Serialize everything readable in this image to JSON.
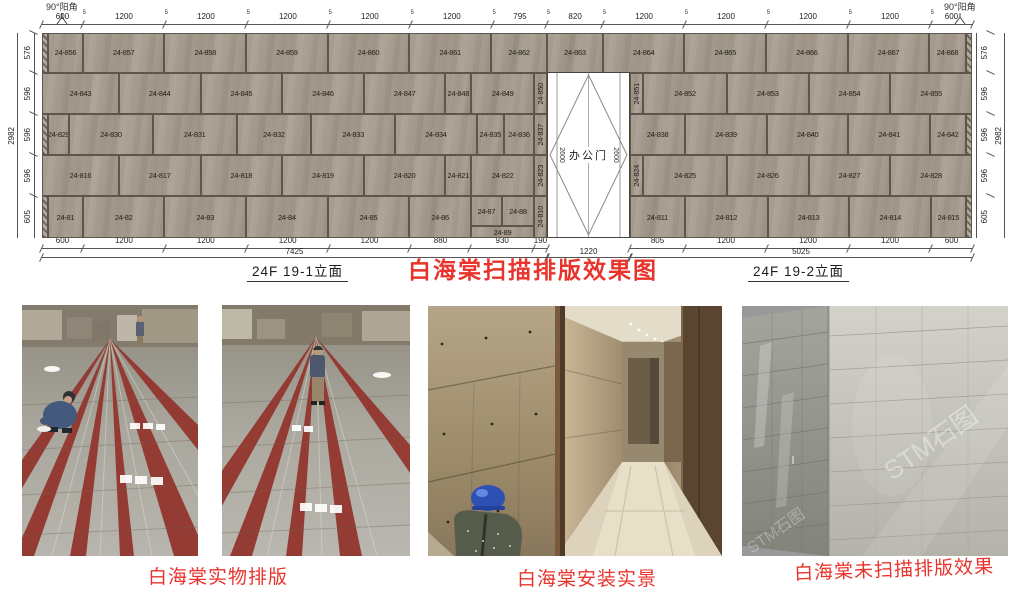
{
  "drawing": {
    "title": "白海棠扫描排版效果图",
    "corner_left": "90°阳角",
    "corner_right": "90°阳角",
    "elev_left_label": "24F 19-1立面",
    "elev_right_label": "24F 19-2立面",
    "door": {
      "label": "办公门",
      "height_dim": "2600",
      "width_dim": "1220"
    },
    "totals": {
      "left": "7425",
      "door": "1220",
      "right": "5025",
      "height": "2982"
    },
    "joint": "5",
    "top_dims": [
      600,
      1200,
      1200,
      1200,
      1200,
      1200,
      795,
      820,
      1200,
      1200,
      1200,
      1200,
      600
    ],
    "bottom_dims_left": [
      600,
      1200,
      1200,
      1200,
      1200,
      880,
      930,
      190
    ],
    "bottom_dims_right": [
      805,
      1200,
      1200,
      1200,
      600
    ],
    "side_dims": [
      576,
      596,
      596,
      596,
      605
    ],
    "rows": [
      {
        "h": 576,
        "panels": [
          {
            "hatch": 1,
            "w": 90
          },
          {
            "l": "24-856",
            "w": 510
          },
          {
            "l": "24-857",
            "w": 1200
          },
          {
            "l": "24-858",
            "w": 1200
          },
          {
            "l": "24-859",
            "w": 1200
          },
          {
            "l": "24-860",
            "w": 1200
          },
          {
            "l": "24-861",
            "w": 1200
          },
          {
            "l": "24-862",
            "w": 825
          },
          {
            "l": "24-863",
            "w": 820
          },
          {
            "l": "24-864",
            "w": 1200
          },
          {
            "l": "24-865",
            "w": 1200
          },
          {
            "l": "24-866",
            "w": 1200
          },
          {
            "l": "24-867",
            "w": 1200
          },
          {
            "l": "24-868",
            "w": 535
          },
          {
            "hatch": 1,
            "w": 90
          }
        ]
      },
      {
        "h": 596,
        "panels": [
          {
            "l": "24-843",
            "w": 1130
          },
          {
            "l": "24-844",
            "w": 1200
          },
          {
            "l": "24-845",
            "w": 1200
          },
          {
            "l": "24-846",
            "w": 1200
          },
          {
            "l": "24-847",
            "w": 1200
          },
          {
            "l": "24-848",
            "w": 380
          },
          {
            "l": "24-849",
            "w": 925
          },
          {
            "l": "24-850",
            "w": 190,
            "v": 1
          },
          {
            "gap": 1,
            "w": 1220
          },
          {
            "l": "24-851",
            "w": 190,
            "v": 1
          },
          {
            "l": "24-852",
            "w": 1235
          },
          {
            "l": "24-853",
            "w": 1200
          },
          {
            "l": "24-854",
            "w": 1200
          },
          {
            "l": "24-855",
            "w": 1200
          }
        ]
      },
      {
        "h": 596,
        "panels": [
          {
            "hatch": 1,
            "w": 90
          },
          {
            "l": "24-829",
            "w": 310
          },
          {
            "l": "24-830",
            "w": 1230
          },
          {
            "l": "24-831",
            "w": 1230
          },
          {
            "l": "24-832",
            "w": 1100
          },
          {
            "l": "24-833",
            "w": 1230
          },
          {
            "l": "24-834",
            "w": 1200
          },
          {
            "l": "24-835",
            "w": 400
          },
          {
            "l": "24-836",
            "w": 445
          },
          {
            "l": "24-837",
            "w": 190,
            "v": 1
          },
          {
            "gap": 1,
            "w": 1220
          },
          {
            "l": "24-838",
            "w": 810
          },
          {
            "l": "24-839",
            "w": 1200
          },
          {
            "l": "24-840",
            "w": 1200
          },
          {
            "l": "24-841",
            "w": 1200
          },
          {
            "l": "24-842",
            "w": 525
          },
          {
            "hatch": 1,
            "w": 90
          }
        ]
      },
      {
        "h": 596,
        "panels": [
          {
            "l": "24-816",
            "w": 1130
          },
          {
            "l": "24-817",
            "w": 1200
          },
          {
            "l": "24-818",
            "w": 1200
          },
          {
            "l": "24-819",
            "w": 1200
          },
          {
            "l": "24-820",
            "w": 1200
          },
          {
            "l": "24-821",
            "w": 380
          },
          {
            "l": "24-822",
            "w": 925
          },
          {
            "l": "24-823",
            "w": 190,
            "v": 1
          },
          {
            "gap": 1,
            "w": 1220
          },
          {
            "l": "24-824",
            "w": 190,
            "v": 1
          },
          {
            "l": "24-825",
            "w": 1235
          },
          {
            "l": "24-826",
            "w": 1200
          },
          {
            "l": "24-827",
            "w": 1200
          },
          {
            "l": "24-828",
            "w": 1200
          }
        ]
      },
      {
        "h": 605,
        "panels": [
          {
            "hatch": 1,
            "w": 90
          },
          {
            "l": "24-81",
            "w": 510
          },
          {
            "l": "24-82",
            "w": 1200
          },
          {
            "l": "24-83",
            "w": 1200
          },
          {
            "l": "24-84",
            "w": 1200
          },
          {
            "l": "24-85",
            "w": 1200
          },
          {
            "l": "24-86",
            "w": 905
          },
          {
            "stack": 1,
            "w": 930,
            "top": [
              {
                "l": "24-87",
                "w": 455
              },
              {
                "l": "24-88",
                "w": 475
              }
            ],
            "bottom": "24-89"
          },
          {
            "l": "24-810",
            "w": 190,
            "v": 1
          },
          {
            "gap": 1,
            "w": 1220
          },
          {
            "l": "24-811",
            "w": 805
          },
          {
            "l": "24-812",
            "w": 1220
          },
          {
            "l": "24-813",
            "w": 1200
          },
          {
            "l": "24-814",
            "w": 1200
          },
          {
            "l": "24-815",
            "w": 510
          },
          {
            "hatch": 1,
            "w": 90
          }
        ]
      }
    ]
  },
  "photos": {
    "captions": [
      {
        "text": "白海棠实物排版"
      },
      {
        "text": "白海棠安装实景"
      },
      {
        "text": "白海棠未扫描排版效果"
      }
    ],
    "watermark": "STM石图"
  },
  "colors": {
    "accent_red": "#e8342c",
    "stone": "#a69c8e"
  }
}
